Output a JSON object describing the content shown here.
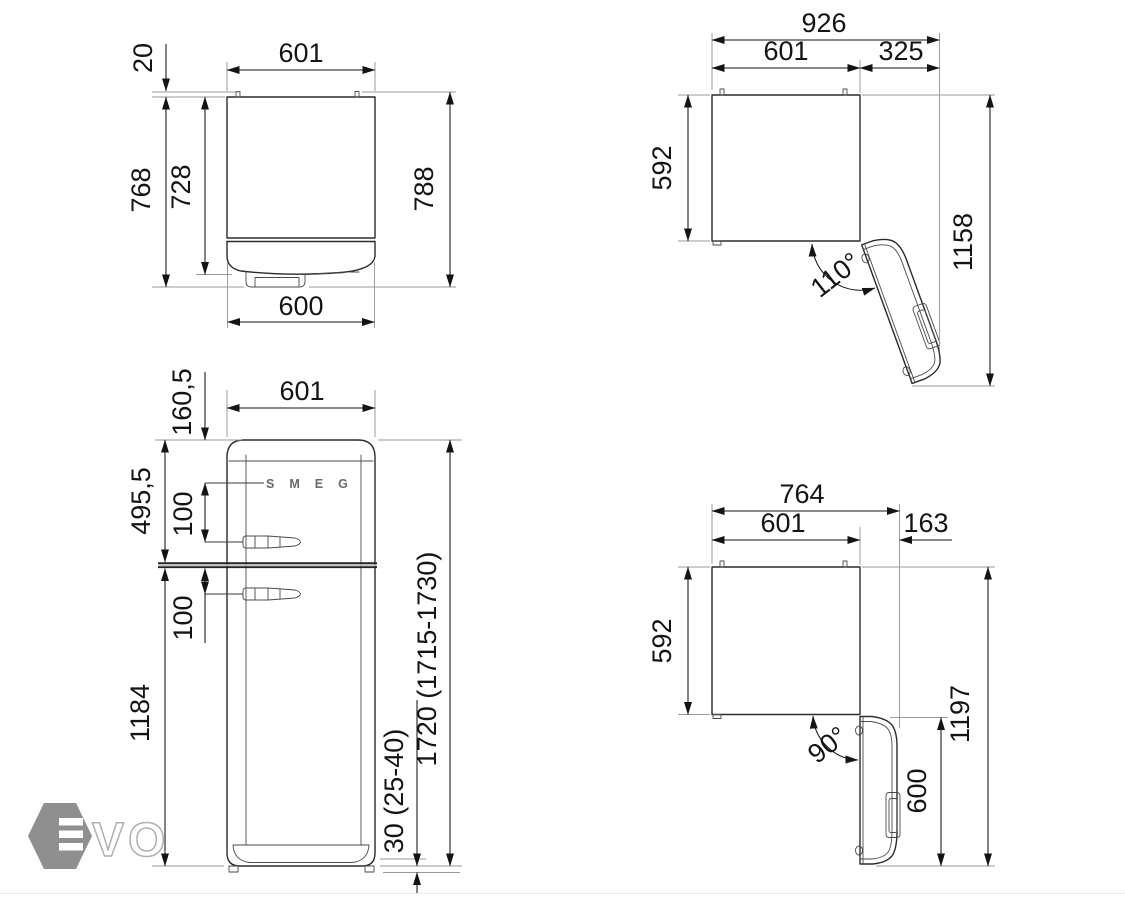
{
  "views": {
    "top_view_door_closed": {
      "label_body_width": "601",
      "label_hinge_protrusion": "20",
      "label_depth_with_door": "768",
      "label_depth_body": "728",
      "label_depth_overall": "788",
      "label_door_width": "600"
    },
    "top_view_door_open_110": {
      "label_overall_width": "926",
      "label_body_width": "601",
      "label_door_clearance": "325",
      "label_body_depth": "592",
      "label_overall_depth": "1158",
      "label_door_angle": "110°"
    },
    "front_view": {
      "label_width": "601",
      "label_top_to_logo": "160,5",
      "label_freezer_section_height": "495,5",
      "label_logo_to_handle": "100",
      "label_divider_to_handle": "100",
      "label_fridge_section_height": "1184",
      "label_overall_height": "1720 (1715-1730)",
      "label_feet_height": "30 (25-40)",
      "brand_logo": "SMEG"
    },
    "top_view_door_open_90": {
      "label_overall_width": "764",
      "label_body_width": "601",
      "label_door_protrusion": "163",
      "label_body_depth": "592",
      "label_overall_depth": "1197",
      "label_open_door_depth": "600",
      "label_door_angle": "90°"
    }
  },
  "watermark": {
    "full_brand": "EVO",
    "outline_letters": "VO"
  }
}
